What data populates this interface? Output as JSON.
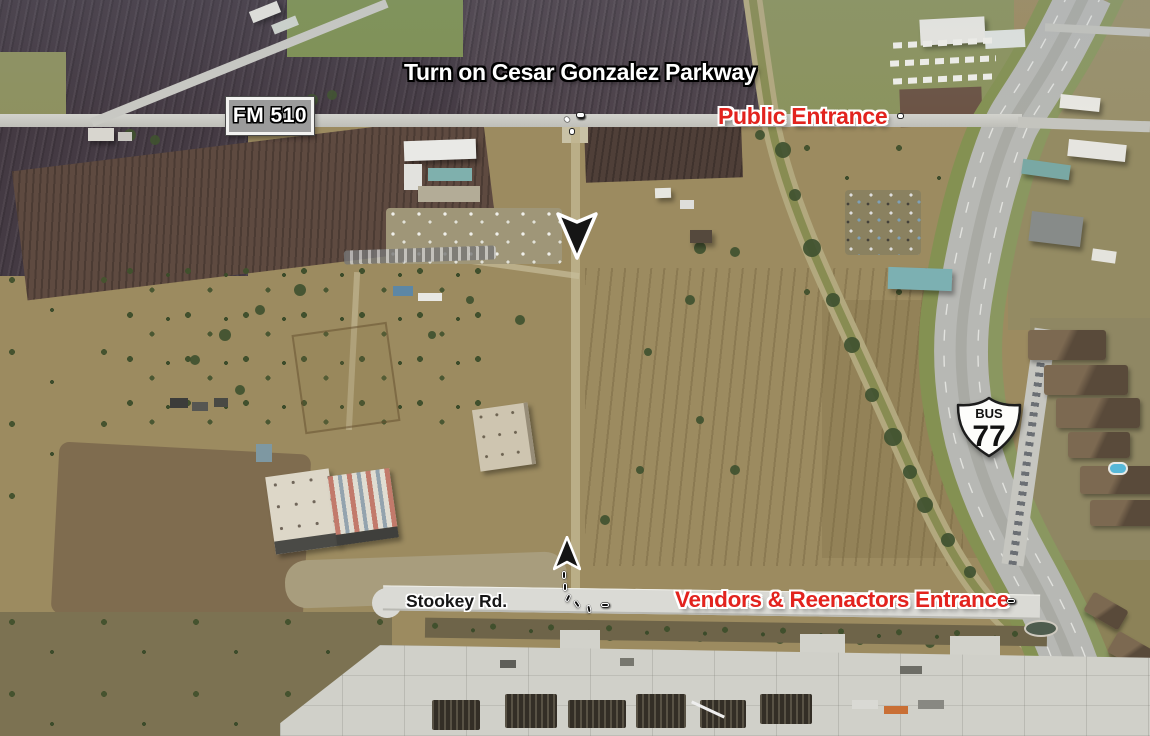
{
  "annotations": {
    "instruction": "Turn on Cesar Gonzalez Parkway",
    "public_entrance_label": "Public Entrance",
    "vendors_entrance_label": "Vendors & Reenactors Entrance"
  },
  "roads": {
    "stookey_label": "Stookey Rd.",
    "fm_shield_label": "FM 510",
    "bus_shield_banner": "BUS",
    "bus_shield_number": "77"
  },
  "icons": {
    "public_route_arrow": "down-arrow-icon",
    "vendors_route_arrow": "up-arrow-icon",
    "fm_route_marker": "texas-fm-shield-icon",
    "bus_route_marker": "us-route-shield-icon"
  },
  "colors": {
    "entrance_red": "#E2231E",
    "annotation_white": "#FFFFFF",
    "road_label_black": "#161616",
    "fm_plate_gray": "#9B9B9B",
    "route_shield_white": "#FDFDFB"
  }
}
